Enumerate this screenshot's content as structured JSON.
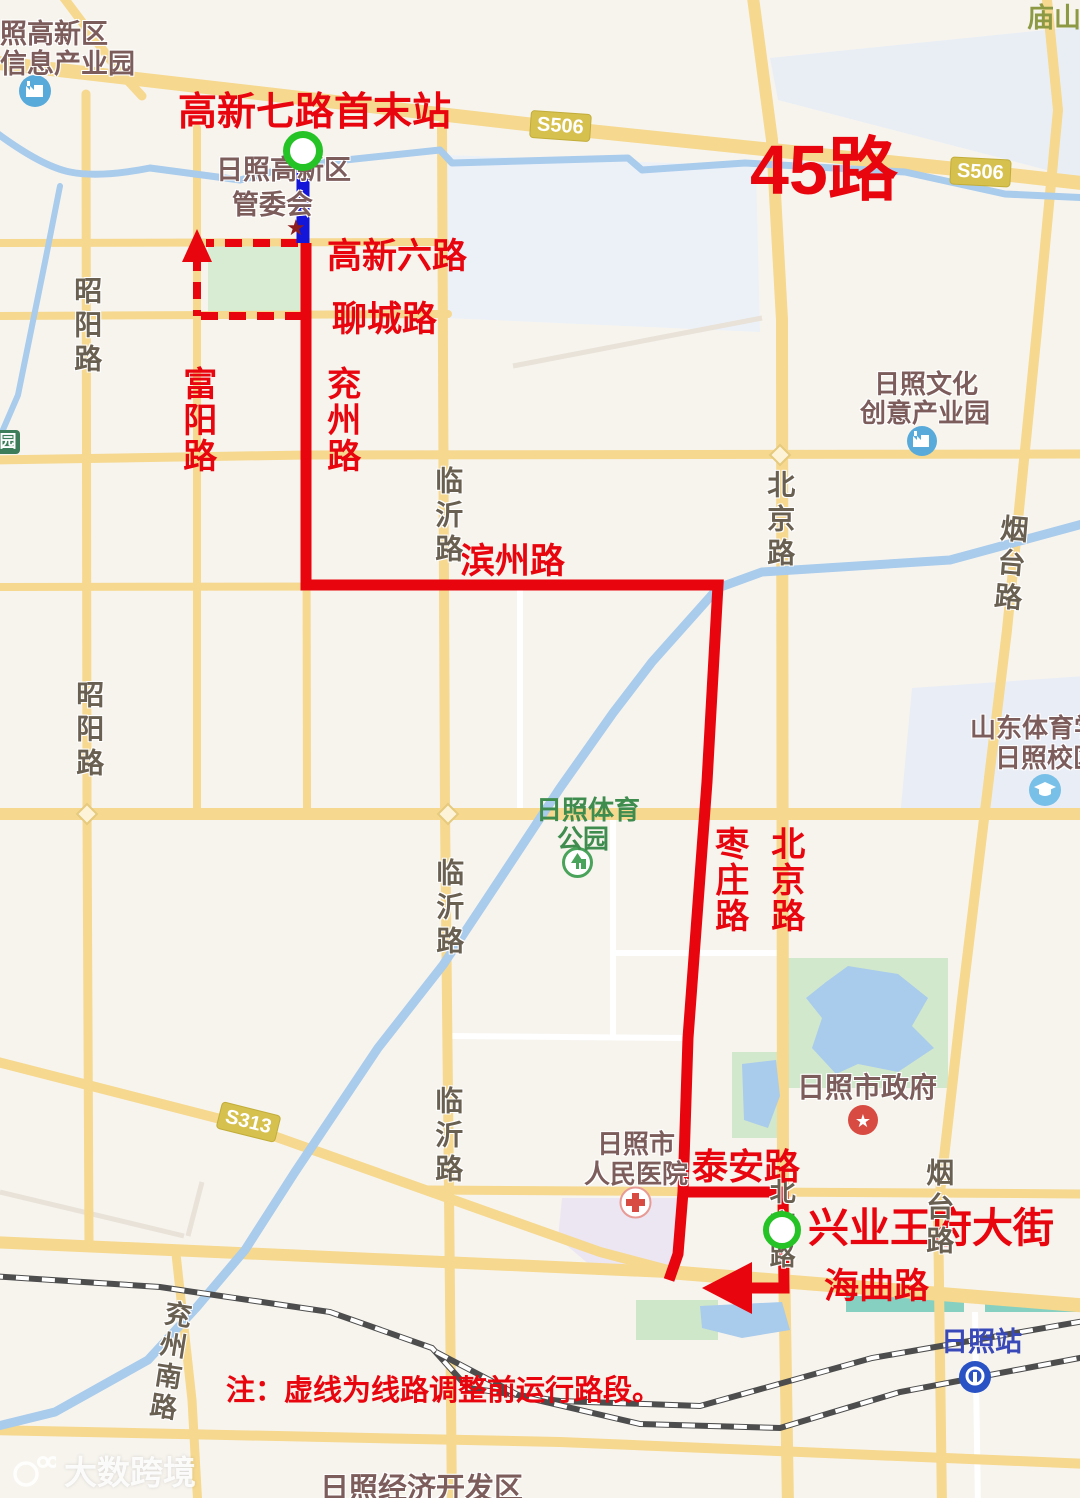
{
  "route": {
    "number": "45路",
    "terminal_start": "高新七路首末站",
    "terminal_end": "兴业王府大街",
    "note": "注：虚线为线路调整前运行路段。"
  },
  "streets_red": {
    "gaoxinliu": "高新六路",
    "liaocheng": "聊城路",
    "fuyang": "富阳路",
    "yanzhou": "兖州路",
    "binzhou": "滨州路",
    "zaozhuang": "枣庄路",
    "beijing": "北京路",
    "taian": "泰安路",
    "haiqu": "海曲路"
  },
  "streets_map": {
    "zhaoyang": "昭阳路",
    "linyi": "临沂路",
    "beijing": "北京路",
    "yantai": "烟台路",
    "yanzhounan": "兖州南路",
    "miaoshan": "庙山南"
  },
  "badges": {
    "s506": "S506",
    "s313": "S313"
  },
  "pois": {
    "industry_park_l1": "照高新区",
    "industry_park_l2": "信息产业园",
    "admin_l1": "日照高新区",
    "admin_l2": "管委会",
    "admin_star": "★",
    "culture_l1": "日照文化",
    "culture_l2": "创意产业园",
    "sports_park_l1": "日照体育",
    "sports_park_l2": "公园",
    "college_l1": "山东体育学",
    "college_l2": "日照校区",
    "government": "日照市政府",
    "hospital_l1": "日照市",
    "hospital_l2": "人民医院",
    "station": "日照站",
    "dev_zone": "日照经济开发区",
    "park_badge": "园"
  },
  "watermark": {
    "brand": "大数跨境"
  },
  "colors": {
    "route_red": "#e8050e",
    "route_blue": "#1316d9",
    "terminal_green": "#25c325",
    "road_yellow": "#f6d88e",
    "river_blue": "#a9cbec"
  }
}
